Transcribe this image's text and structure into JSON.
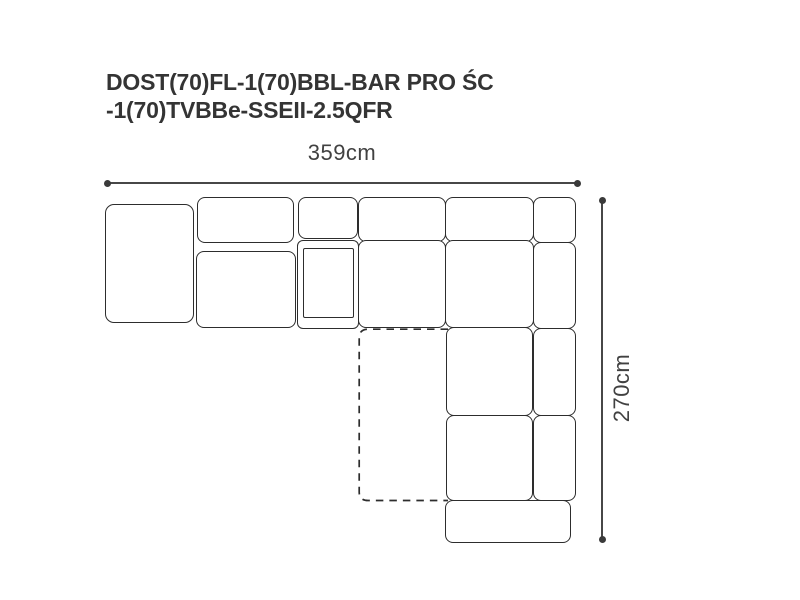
{
  "title": {
    "line1": "DOST(70)FL-1(70)BBL-BAR PRO ŚC",
    "line2": "-1(70)TVBBe-SSEII-2.5QFR"
  },
  "dimensions": {
    "width_label": "359cm",
    "height_label": "270cm"
  },
  "colors": {
    "background": "#ffffff",
    "module_outline": "#2d2d2d",
    "dimension_line": "#474747",
    "title_text": "#343434",
    "dimension_text": "#414141"
  }
}
